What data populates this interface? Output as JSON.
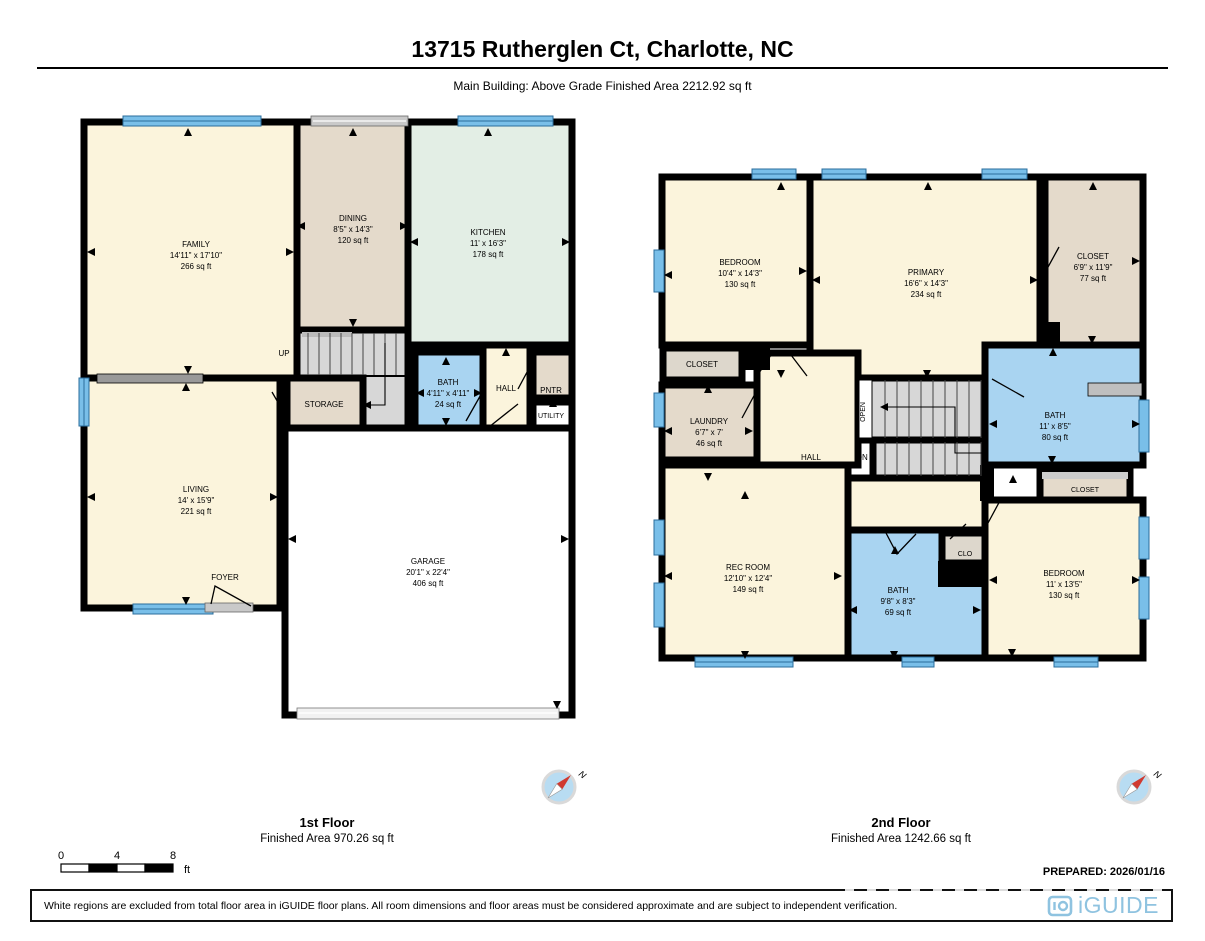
{
  "header": {
    "title": "13715 Rutherglen Ct, Charlotte, NC",
    "subtitle": "Main Building: Above Grade Finished Area 2212.92 sq ft"
  },
  "colors": {
    "room_cream": "#FBF4DC",
    "room_tan": "#E4DACB",
    "room_tan2": "#DDD7CC",
    "room_mint": "#E3EEE5",
    "room_blue": "#A9D4F1",
    "room_white": "#FFFFFF",
    "stairs_gray": "#D7D7D7",
    "wall_black": "#000000",
    "window_blue": "#79BFE9",
    "window_line": "#2A6D9C",
    "door_gray": "#C9C9C9",
    "beam_gray": "#999999",
    "counter_gray": "#BFBFBF",
    "compass_blue": "#B8DCF2",
    "compass_red": "#D03A30",
    "logo_blue": "#8FC3E0"
  },
  "icons": {
    "compass": "compass-rose-north",
    "logo_mark": "iguide-camera-mark"
  },
  "floor1": {
    "label": "1st Floor",
    "area_label": "Finished Area 970.26 sq ft",
    "rooms": {
      "family": {
        "name": "FAMILY",
        "dims": "14'11\" x 17'10\"",
        "area": "266 sq ft"
      },
      "dining": {
        "name": "DINING",
        "dims": "8'5\" x 14'3\"",
        "area": "120 sq ft"
      },
      "kitchen": {
        "name": "KITCHEN",
        "dims": "11' x 16'3\"",
        "area": "178 sq ft"
      },
      "bath": {
        "name": "BATH",
        "dims": "4'11\" x 4'11\"",
        "area": "24 sq ft"
      },
      "living": {
        "name": "LIVING",
        "dims": "14' x 15'9\"",
        "area": "221 sq ft"
      },
      "garage": {
        "name": "GARAGE",
        "dims": "20'1\" x 22'4\"",
        "area": "406 sq ft"
      },
      "storage": {
        "name": "STORAGE"
      },
      "hall": {
        "name": "HALL"
      },
      "pantry": {
        "name": "PNTR"
      },
      "utility": {
        "name": "UTILITY"
      },
      "foyer": {
        "name": "FOYER"
      },
      "up": {
        "name": "UP"
      }
    }
  },
  "floor2": {
    "label": "2nd Floor",
    "area_label": "Finished Area 1242.66 sq ft",
    "rooms": {
      "bedroom1": {
        "name": "BEDROOM",
        "dims": "10'4\" x 14'3\"",
        "area": "130 sq ft"
      },
      "primary": {
        "name": "PRIMARY",
        "dims": "16'6\" x 14'3\"",
        "area": "234 sq ft"
      },
      "closet_primary": {
        "name": "CLOSET",
        "dims": "6'9\" x 11'9\"",
        "area": "77 sq ft"
      },
      "closet_small": {
        "name": "CLOSET"
      },
      "laundry": {
        "name": "LAUNDRY",
        "dims": "6'7\" x 7'",
        "area": "46 sq ft"
      },
      "hall": {
        "name": "HALL"
      },
      "dn": {
        "name": "DN"
      },
      "open": {
        "name": "OPEN"
      },
      "bath_upper": {
        "name": "BATH",
        "dims": "11' x 8'5\"",
        "area": "80 sq ft"
      },
      "closet_bath": {
        "name": "CLOSET"
      },
      "rec_room": {
        "name": "REC ROOM",
        "dims": "12'10\" x 12'4\"",
        "area": "149 sq ft"
      },
      "bath_lower": {
        "name": "BATH",
        "dims": "9'8\" x 8'3\"",
        "area": "69 sq ft"
      },
      "clo": {
        "name": "CLO"
      },
      "bedroom2": {
        "name": "BEDROOM",
        "dims": "11' x 13'5\"",
        "area": "130 sq ft"
      }
    }
  },
  "scale_bar": {
    "ticks": [
      "0",
      "4",
      "8"
    ],
    "unit": "ft"
  },
  "compass": {
    "north_label": "N"
  },
  "footer": {
    "prepared": "PREPARED: 2026/01/16",
    "disclaimer": "White regions are excluded from total floor area in iGUIDE floor plans. All room dimensions and floor areas must be considered approximate and are subject to independent verification.",
    "brand": "iGUIDE"
  }
}
